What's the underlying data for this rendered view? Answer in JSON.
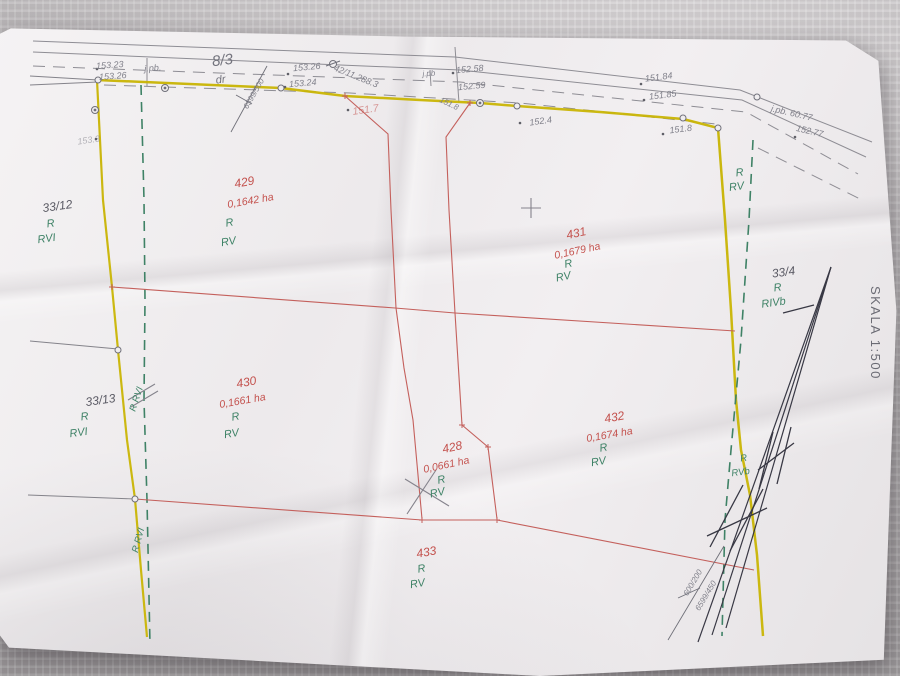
{
  "scale_label": "SKALA 1:500",
  "road": {
    "parcel_id": "8/3",
    "land_use": "dr"
  },
  "measurements": {
    "m1": "153.23",
    "m2": "153.26",
    "m3": "j.pb.",
    "m4": "153.26",
    "m5": "153.24",
    "m6": "42/11.288.3",
    "m7": "j.pb",
    "m8": "152.58",
    "m9": "152.59",
    "m10": "151.8",
    "m11": "151.7",
    "m12": "152.4",
    "m13": "151.84",
    "m14": "151.85",
    "m15": "151.8",
    "m16": "j.pb. 60.77",
    "m17": "152.77",
    "m18": "153.3"
  },
  "point_ids": {
    "p1": "6599/500",
    "p2": "600/200",
    "p3": "6599/450"
  },
  "parcels": {
    "p429": {
      "id": "429",
      "area": "0,1642 ha",
      "cls": "R",
      "sub": "RV"
    },
    "p430": {
      "id": "430",
      "area": "0,1661 ha",
      "cls": "R",
      "sub": "RV"
    },
    "p431": {
      "id": "431",
      "area": "0,1679 ha",
      "cls": "R",
      "sub": "RV"
    },
    "p432": {
      "id": "432",
      "area": "0,1674 ha",
      "cls": "R",
      "sub": "RV"
    },
    "p428": {
      "id": "428",
      "area": "0,0661 ha",
      "cls": "R",
      "sub": "RV"
    },
    "p433": {
      "id": "433",
      "cls": "R",
      "sub": "RV"
    },
    "p33_12": {
      "id": "33/12",
      "cls": "R",
      "sub": "RVI"
    },
    "p33_13": {
      "id": "33/13",
      "cls": "R",
      "sub": "RVI"
    },
    "p33_4": {
      "id": "33/4",
      "cls": "R",
      "sub": "RIVb"
    }
  },
  "edge_notes": {
    "right_r": "R",
    "right_rv": "RV",
    "rvb_r": "R",
    "rvb": "RVb",
    "line_note1": "R RVI",
    "line_note2": "R RVI"
  },
  "colors": {
    "boundary_yellow": "#c9b504",
    "class_green": "#3e8266",
    "parcel_red": "#c4524e",
    "survey_gray": "#8b8a91",
    "pen_ink": "#383844"
  }
}
